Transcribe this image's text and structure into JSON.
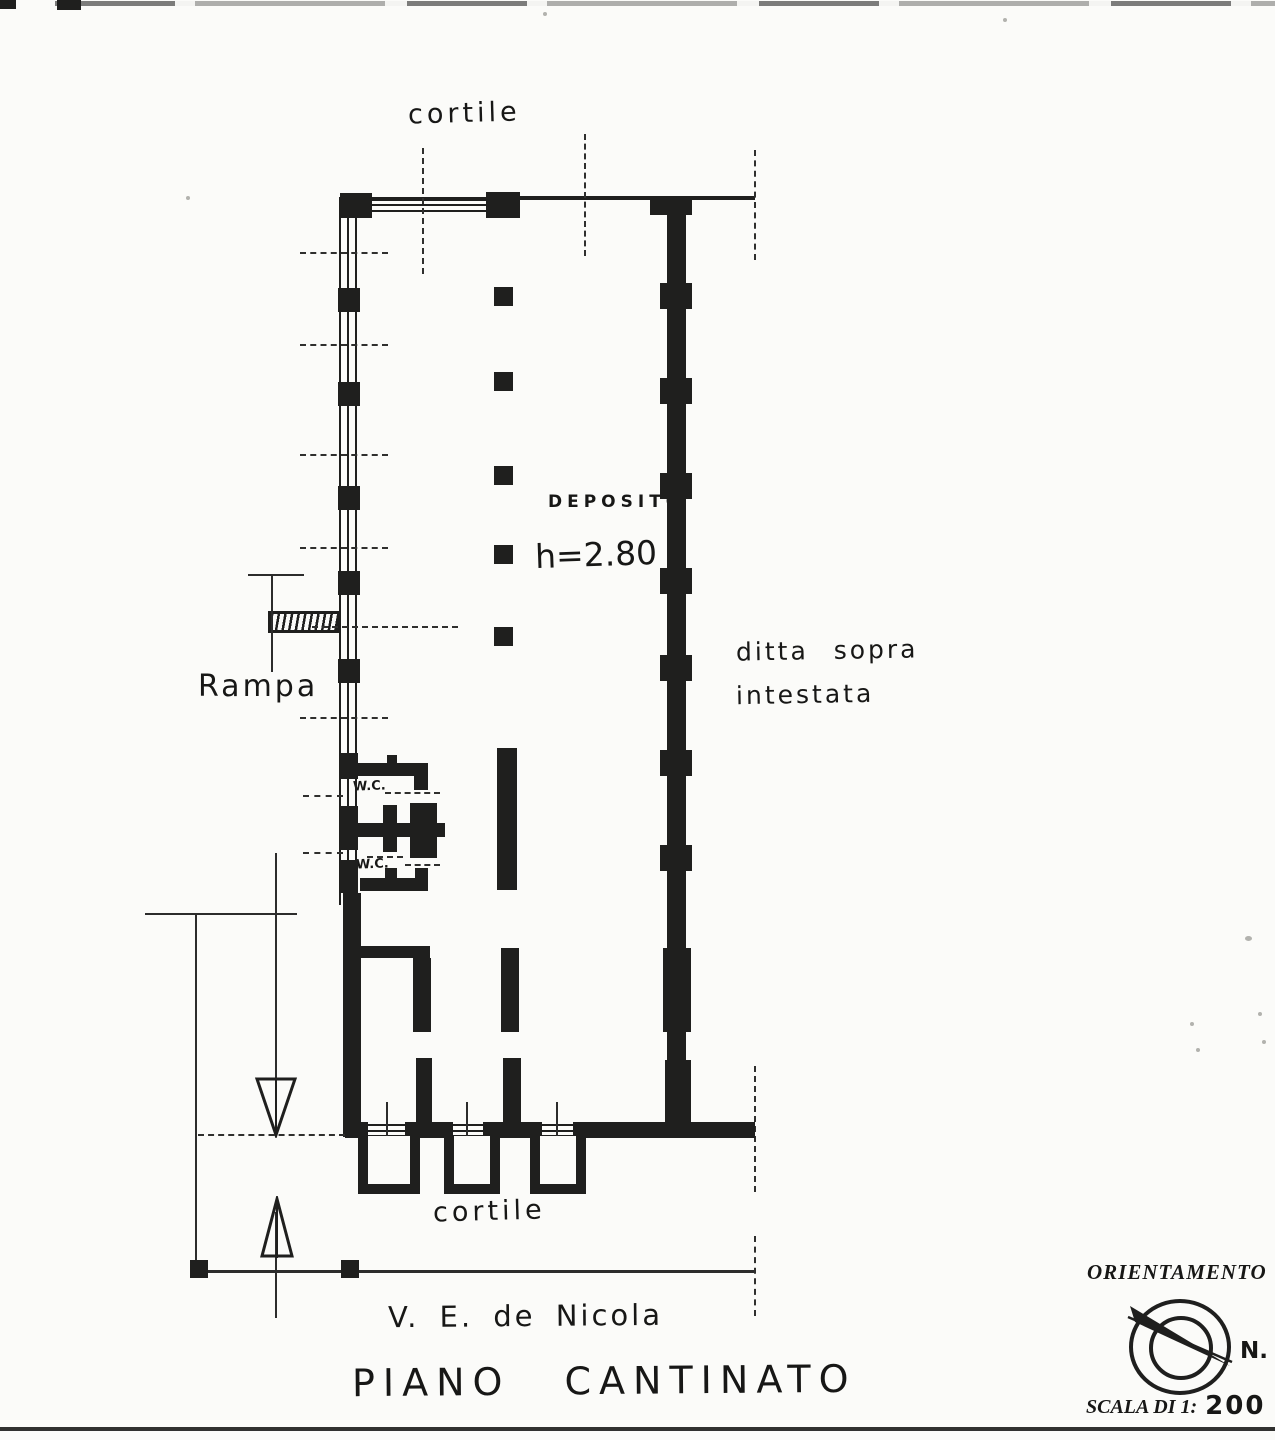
{
  "colors": {
    "ink": "#1f1f1e",
    "paper": "#fbfbf9"
  },
  "labels": {
    "courtyard_top": "cortile",
    "deposito": "DEPOSITO",
    "height_note": "h=2.80",
    "right_note_line1": "ditta sopra",
    "right_note_line2": "intestata",
    "ramp": "Rampa",
    "wc_upper": "W.C.",
    "wc_lower": "W.C.",
    "courtyard_bottom": "cortile",
    "street_name": "V. E. de Nicola",
    "plan_title": "PIANO CANTINATO",
    "orientation_title": "ORIENTAMENTO",
    "north_label": "N.",
    "scale_label": "SCALA DI 1:",
    "scale_value": "200"
  }
}
